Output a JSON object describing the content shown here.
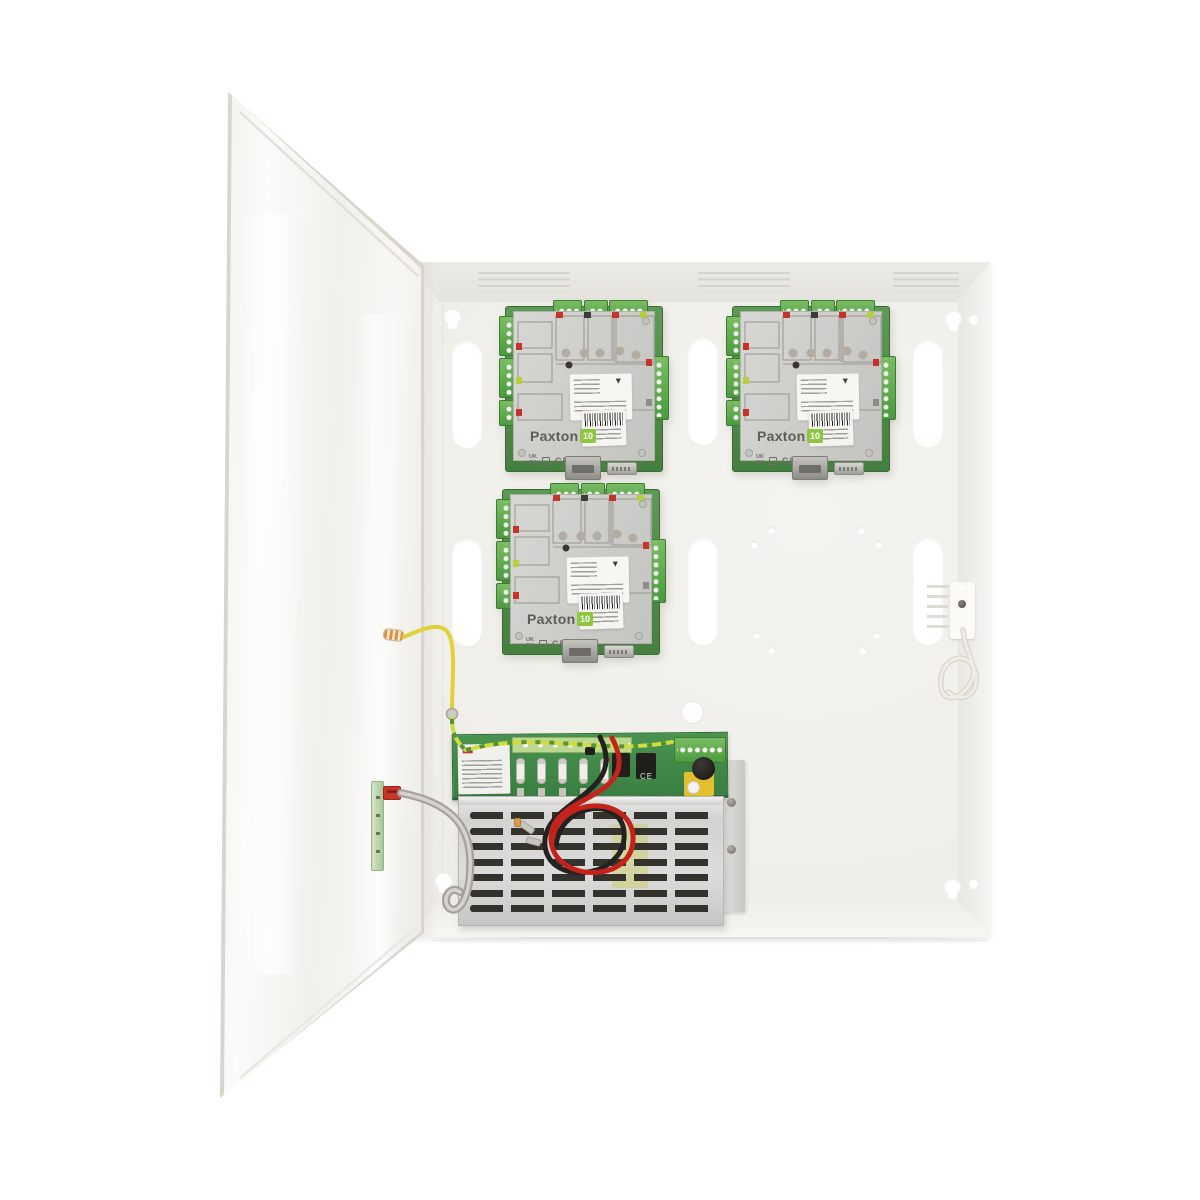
{
  "meta": {
    "subject": "Paxton10 access control unit: open white metal cabinet containing three Paxton10 door controller boards and a power supply unit with battery leads"
  },
  "icons": {
    "triangle_mark": "▼"
  },
  "controller_board": {
    "brand": "Paxton",
    "brand_suffix": "10",
    "ukca_top": "UK",
    "ukca_bottom": "CA",
    "ce": "CE"
  },
  "psu": {
    "ce": "CE"
  },
  "colors": {
    "background": "#ffffff",
    "enclosure": "#f1efeb",
    "pcb_green": "#49934f",
    "terminal_green": "#55a44a",
    "brand_green": "#8dc63f",
    "wire_yellow": "#e0d13b",
    "wire_green_yellow": "#cddd3f",
    "wire_red": "#c4231c",
    "wire_black": "#242220",
    "psu_cover_silver": "#d8d8d6"
  }
}
